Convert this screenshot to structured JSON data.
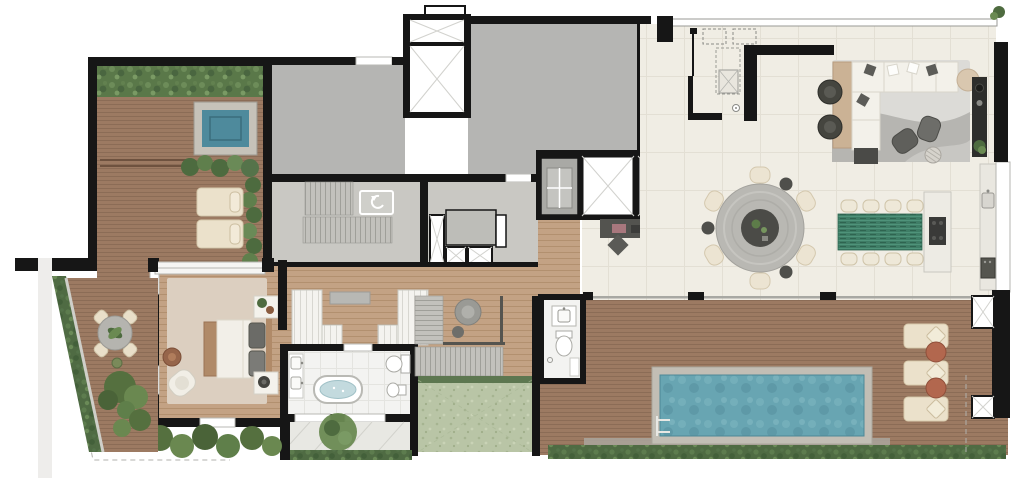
{
  "canvas": {
    "width": 1025,
    "height": 480
  },
  "palette": {
    "wall": "#161616",
    "core_floor": "#b5b5b3",
    "concrete_floor": "#c9c8c3",
    "deck_wood": "#9c7a62",
    "deck_stripe": "#8b6c56",
    "interior_wood": "#c3a284",
    "interior_wood_stripe": "#b2906f",
    "tile": "#f0ede4",
    "tile_line": "#e3dfd4",
    "bath_tile": "#f3f3f1",
    "hedge_green": "#4f6b43",
    "foliage_green": "#63814d",
    "lawn_green": "#b9c5a6",
    "jacuzzi_water": "#4e8a9c",
    "pool_water": "#68a5b2",
    "stone_border": "#c2beb5",
    "tub_water": "#c3dade",
    "sofa_white": "#f3f1ea",
    "cushion_gray": "#5c5c58",
    "rug_gray": "#dcdbd7",
    "rug_wave": "#b6b5b1",
    "rug_beige": "#dccfc0",
    "console_wood": "#cbb295",
    "dining_table_gray": "#b9b8b3",
    "dining_table_center": "#4b4b47",
    "chair_cream": "#ece4d2",
    "green_table": "#3f7d66",
    "island_white": "#edebe4",
    "cooktop": "#3a3a38",
    "counter": "#e9e7e0",
    "appliance": "#55554f",
    "lounger_cream": "#ebe1cb",
    "terracotta": "#b2674e",
    "bed_wood": "#b08a68",
    "mattress": "#f2efe8",
    "pillow_gray": "#6b6b67",
    "armchair_dark": "#5f5f5b",
    "tv_wall": "#2e2e2c",
    "desk_dark": "#53534f",
    "elevator_x_line": "#d2d2ce",
    "paver": "#e8e8e3",
    "walkway": "#aaa69e"
  },
  "icons": [
    {
      "name": "elevator-x-icon"
    },
    {
      "name": "stair-turn-arrow-icon"
    },
    {
      "name": "floor-drain-icon"
    },
    {
      "name": "pool-ladder-icon"
    }
  ],
  "rooms": [
    {
      "id": "roof-garden-terrace"
    },
    {
      "id": "building-core"
    },
    {
      "id": "common-stairs"
    },
    {
      "id": "service-shaft-room"
    },
    {
      "id": "elevator-lobby"
    },
    {
      "id": "living-dining-room"
    },
    {
      "id": "laundry-service-room"
    },
    {
      "id": "kitchen-island-area"
    },
    {
      "id": "pool-deck"
    },
    {
      "id": "powder-room"
    },
    {
      "id": "master-bedroom"
    },
    {
      "id": "walk-in-closet"
    },
    {
      "id": "master-bathroom"
    },
    {
      "id": "private-stairs"
    },
    {
      "id": "internal-garden"
    },
    {
      "id": "side-terrace"
    },
    {
      "id": "rear-patio"
    }
  ],
  "furniture_counts": {
    "roof_loungers": 2,
    "pool_loungers": 3,
    "round_dining_chairs": 6,
    "long_table_chairs": 8,
    "terrace_chairs": 4,
    "elevators": 2,
    "service_elevator": 1
  }
}
